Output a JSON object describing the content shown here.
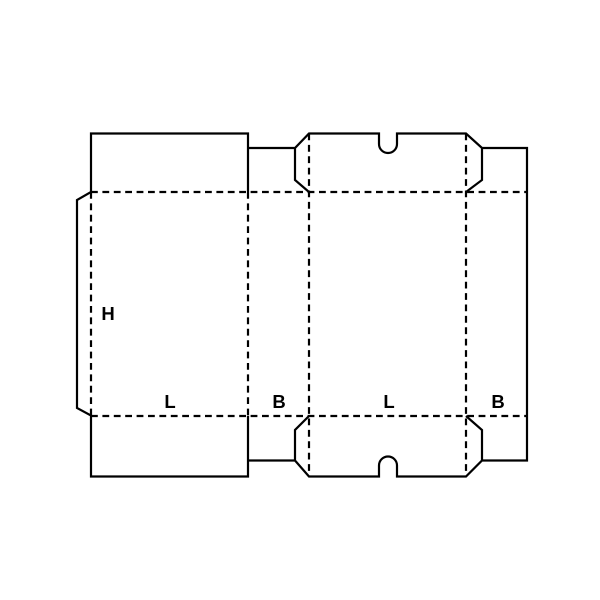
{
  "page": {
    "background_color": "#ffffff",
    "line_color": "#000000"
  },
  "diagram": {
    "kind": "carton-dieline-blank",
    "description": "Flat die-cut blank of a slotted box: solid lines are cuts, dashed lines are folds",
    "labels": {
      "height": "H",
      "length_left": "L",
      "breadth_left": "B",
      "length_right": "L",
      "breadth_right": "B"
    }
  }
}
